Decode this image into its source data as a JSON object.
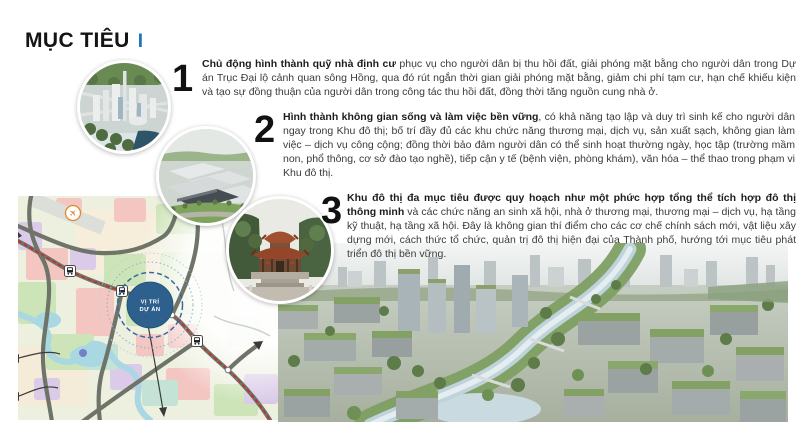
{
  "title": {
    "text": "MỤC TIÊU",
    "accent": "I"
  },
  "objectives": [
    {
      "number": "1",
      "lead": "Chủ động hình thành quỹ nhà định cư",
      "rest": " phục vụ cho người dân bị thu hồi đất, giải phóng mặt bằng cho người dân trong Dự án Trục Đại lộ cảnh quan sông Hồng, qua đó rút ngắn thời gian giải phóng mặt bằng, giảm chi phí tạm cư, hạn chế khiếu kiện và tạo sự đồng thuận của người dân trong công tác thu hồi đất, đồng thời tăng nguồn cung nhà ở."
    },
    {
      "number": "2",
      "lead": "Hình thành không gian sống và làm việc bền vững",
      "rest": ", có khả năng tạo lập và duy trì sinh kế cho người dân ngay trong Khu đô thị; bố trí đầy đủ các khu chức năng thương mại, dịch vụ, sản xuất sạch, không gian làm việc – dịch vụ công cộng; đồng thời bảo đảm người dân có thể sinh hoạt thường ngày, học tập (trường mầm non, phổ thông, cơ sở đào tạo nghề), tiếp cận y tế (bệnh viện, phòng khám), văn hóa – thể thao trong phạm vi Khu đô thị."
    },
    {
      "number": "3",
      "lead": "Khu đô thị đa mục tiêu được quy hoạch như một phức hợp tổng thể tích hợp đô thị thông minh",
      "rest": " và các chức năng an sinh xã hội, nhà ở thương mại, thương mại – dịch vụ, hạ tầng kỹ thuật, hạ tầng xã hội. Đây là không gian thí điểm cho các cơ chế chính sách mới, vật liệu xây dựng mới, cách thức tổ chức, quản trị đô thị hiện đại của Thành phố, hướng tới mục tiêu phát triển đô thị bền vững."
    }
  ],
  "map": {
    "label_line1": "VỊ TRÍ",
    "label_line2": "DỰ ÁN",
    "icons": {
      "airport": "airplane-icon",
      "station": "train-station-icon",
      "project": "project-location-marker"
    }
  },
  "colors": {
    "accent-blue": "#1b75bc",
    "text-dark": "#3a3a3a",
    "number-black": "#111111",
    "map-project-fill": "#2d608d",
    "map-rail-red": "#de1f1f",
    "map-road-gray": "#6e7468"
  }
}
